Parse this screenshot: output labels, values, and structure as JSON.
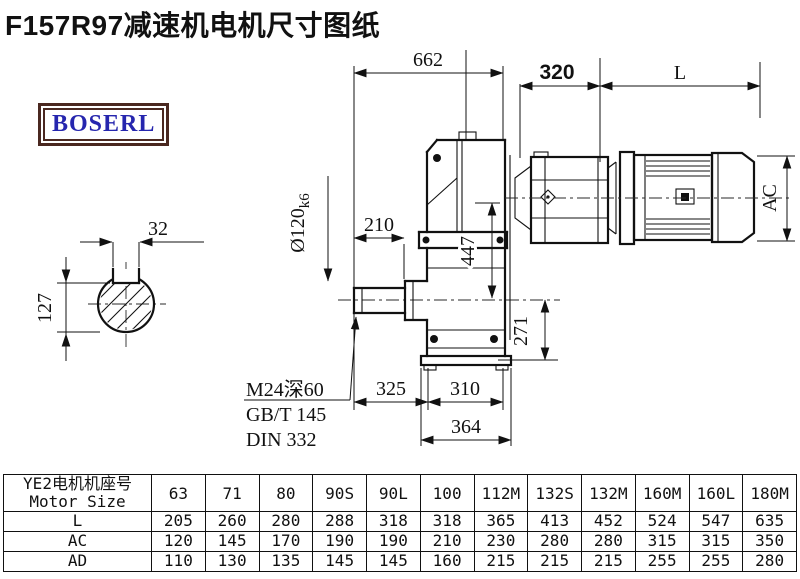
{
  "page": {
    "title": "F157R97减速机电机尺寸图纸",
    "background": "#ffffff"
  },
  "logo": {
    "text": "BOSERL",
    "text_color": "#2626ae",
    "border_color": "#4a2820"
  },
  "drawing": {
    "dims": {
      "overall_length": "662",
      "adapter_length": "320",
      "motor_length": "L",
      "key_width": "32",
      "key_height": "127",
      "shaft_dia": "Ø120",
      "shaft_tol": "k6",
      "hub_length": "210",
      "housing_height": "447",
      "axis_height": "271",
      "foot_left": "325",
      "foot_right": "310",
      "base_length": "364",
      "motor_diameter": "AC",
      "tap_note_1": "M24深60",
      "tap_note_2": "GB/T 145",
      "tap_note_3": "DIN 332"
    }
  },
  "table": {
    "header_cn": "YE2电机机座号",
    "header_en": "Motor Size",
    "sizes": [
      "63",
      "71",
      "80",
      "90S",
      "90L",
      "100",
      "112M",
      "132S",
      "132M",
      "160M",
      "160L",
      "180M"
    ],
    "rows": [
      {
        "label": "L",
        "values": [
          "205",
          "260",
          "280",
          "288",
          "318",
          "318",
          "365",
          "413",
          "452",
          "524",
          "547",
          "635"
        ]
      },
      {
        "label": "AC",
        "values": [
          "120",
          "145",
          "170",
          "190",
          "190",
          "210",
          "230",
          "280",
          "280",
          "315",
          "315",
          "350"
        ]
      },
      {
        "label": "AD",
        "values": [
          "110",
          "130",
          "135",
          "145",
          "145",
          "160",
          "215",
          "215",
          "215",
          "255",
          "255",
          "280"
        ]
      }
    ]
  }
}
